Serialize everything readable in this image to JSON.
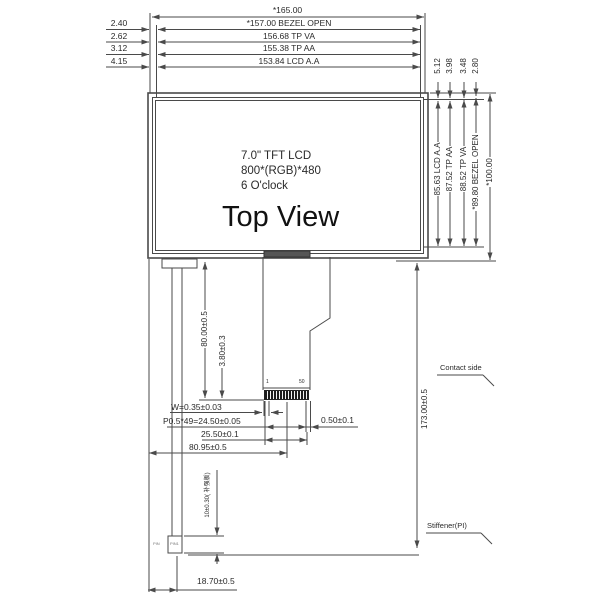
{
  "panel": {
    "spec_line1": "7.0\" TFT LCD",
    "spec_line2": "800*(RGB)*480",
    "spec_line3": "6 O'clock",
    "view_label": "Top View"
  },
  "top_dims": {
    "overall": "*165.00",
    "rows": [
      {
        "offset": "2.40",
        "label": "*157.00 BEZEL OPEN"
      },
      {
        "offset": "2.62",
        "label": "156.68  TP VA"
      },
      {
        "offset": "3.12",
        "label": "155.38  TP AA"
      },
      {
        "offset": "4.15",
        "label": "153.84 LCD A.A"
      }
    ]
  },
  "right_dims": {
    "offsets": [
      "5.12",
      "3.98",
      "3.48",
      "2.80"
    ],
    "verticals": [
      "85.63 LCD A.A",
      "87.52 TP AA",
      "88.52 TP VA",
      "*89.80 BEZEL OPEN",
      "*100.00"
    ]
  },
  "fpc_dims": {
    "fpc_length": "80.00±0.5",
    "stiffener_overlap": "3.80±0.3",
    "pin_width": "W=0.35±0.03",
    "pitch": "P0.5*49=24.50±0.05",
    "edge_margin": "0.50±0.1",
    "contact_span": "25.50±0.1",
    "fpc_offset": "80.95±0.5",
    "tail_offset": "18.70±0.5",
    "foot_height": "10±0.30( 补强板)",
    "total_length": "173.00±0.5",
    "pin_first": "1",
    "pin_last": "50",
    "mark_left": "PIN",
    "mark_right": "PIN1"
  },
  "labels": {
    "contact_side": "Contact side",
    "stiffener": "Stiffener(PI)"
  },
  "colors": {
    "line": "#4a4a4a",
    "text": "#2a2a2a",
    "connector_fill": "#1c1c1c"
  }
}
